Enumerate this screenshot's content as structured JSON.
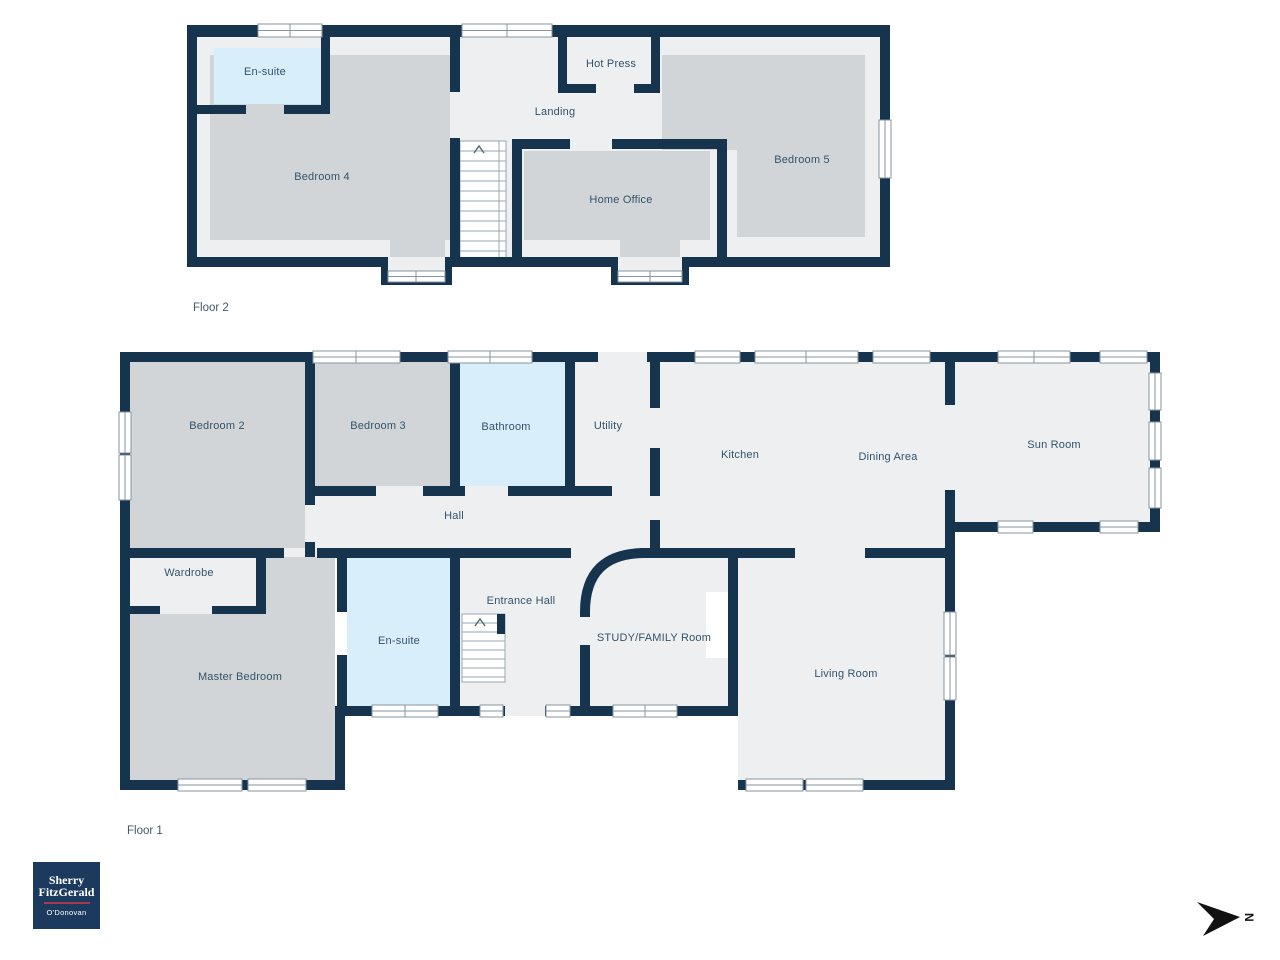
{
  "floor2": {
    "caption": "Floor 2",
    "rooms": {
      "ensuite": "En-suite",
      "bedroom4": "Bedroom 4",
      "hot_press": "Hot Press",
      "landing": "Landing",
      "home_office": "Home Office",
      "bedroom5": "Bedroom 5"
    }
  },
  "floor1": {
    "caption": "Floor 1",
    "rooms": {
      "bedroom2": "Bedroom 2",
      "bedroom3": "Bedroom 3",
      "bathroom": "Bathroom",
      "utility": "Utility",
      "kitchen": "Kitchen",
      "dining": "Dining Area",
      "sun_room": "Sun Room",
      "hall": "Hall",
      "wardrobe": "Wardrobe",
      "master": "Master Bedroom",
      "ensuite": "En-suite",
      "entrance": "Entrance Hall",
      "study": "STUDY/FAMILY Room",
      "living": "Living Room"
    }
  },
  "branding": {
    "line1": "Sherry",
    "line2": "FitzGerald",
    "line3": "O'Donovan"
  },
  "compass": {
    "north_label": "N"
  },
  "colors": {
    "wall": "#17344F",
    "floor": "#EDEFF0",
    "carpet": "#D2D5D7",
    "wet_room": "#D9EEFB",
    "room_label": "#33536B",
    "logo_background": "#1C3A5E",
    "logo_rule": "#A8394E"
  }
}
